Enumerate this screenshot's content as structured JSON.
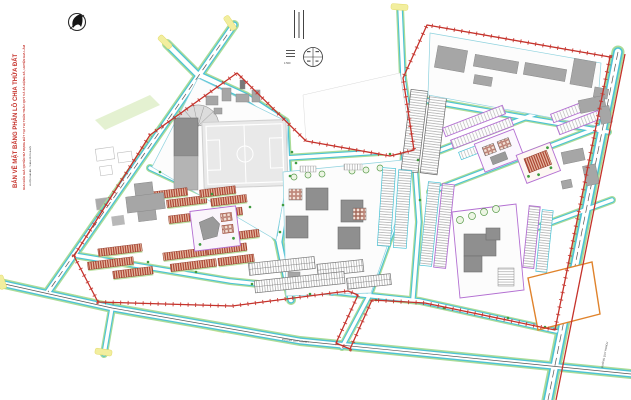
{
  "document": {
    "kind": "urban land subdivision plan drawing",
    "background": "#ffffff"
  },
  "title_block": {
    "line1": "BẢN VẼ MẶT BẰNG PHÂN LÔ CHIA THỬA ĐẤT",
    "line2": "KHU ĐẤU GIÁ QUYỀN SỬ DỤNG ĐẤT TẠI THỊ TRẤN TRÂU QUỲ VÀ XÃ ĐẶNG XÁ, HUYỆN GIA LÂM",
    "line3": "HUYỆN GIA LÂM - THÀNH PHỐ HÀ NỘI",
    "text_color": "#c5322b"
  },
  "annotations": {
    "scale_label": "1:500",
    "road_label_bottom": "ĐƯỜNG QUY HOẠCH",
    "road_label_right": "ĐƯỜNG QUY HOẠCH"
  },
  "symbols": {
    "north_arrow": "north-arrow-compass",
    "land_use_circle": "land-use-balance-circle"
  },
  "legend_colors": {
    "boundary_red": "#c5322b",
    "road_cyan": "#4cc3d6",
    "road_verge_green": "#abdc98",
    "road_end_yellow": "#f2ee9e",
    "building_gray": "#9c9c9c",
    "terraced_house_red": "#a33322",
    "lot_line_purple": "#b36fd2",
    "green_space": "#bfe3a6",
    "special_parcel_orange": "#e0832c"
  }
}
